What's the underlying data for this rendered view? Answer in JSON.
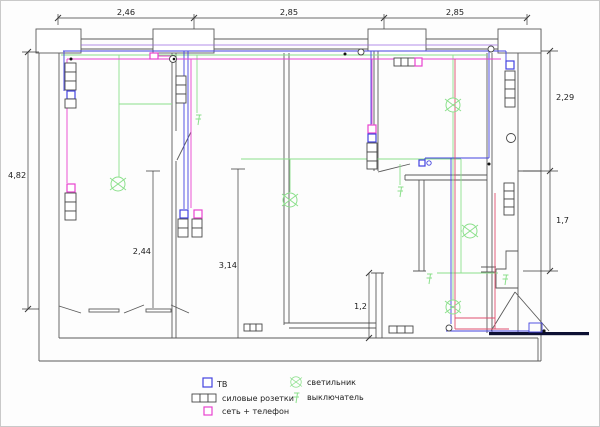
{
  "plan": {
    "dims": {
      "top": [
        "2,46",
        "2,85",
        "2,85"
      ],
      "left": "4,82",
      "right_upper": "2,29",
      "right_lower": "1,7",
      "room_left": "2,44",
      "room_mid": "3,14",
      "bath": "1,2"
    }
  },
  "legend": {
    "tv": "ТВ",
    "power": "силовые розетки",
    "net": "сеть + телефон",
    "light": "светильник",
    "switch": "выключатель"
  },
  "colors": {
    "wall": "#5a5a5a",
    "dim": "#3a3a3a",
    "lighting": "#8ce08c",
    "tv_net": "#4343e0",
    "power_net": "#e843cf",
    "alarm": "#e04f6e",
    "entry_bar": "#0d1033"
  },
  "icons": {
    "ceiling-light-icon": "green circle with X",
    "switch-icon": "green zigzag with bars",
    "tv-socket-icon": "blue outlined square",
    "network-phone-socket-icon": "magenta outlined square",
    "power-sockets-icon": "row of three cells"
  }
}
